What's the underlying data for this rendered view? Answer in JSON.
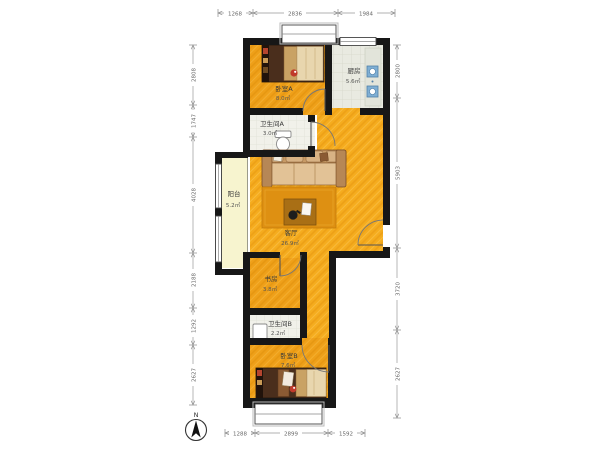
{
  "plan_title": "两室两卫户型平面图",
  "rooms": {
    "bedroom_a": {
      "name": "卧室A",
      "area": "8.0㎡"
    },
    "kitchen": {
      "name": "厨房",
      "area": "5.6㎡"
    },
    "bathroom_a": {
      "name": "卫生间A",
      "area": "3.0㎡"
    },
    "balcony": {
      "name": "阳台",
      "area": "5.2㎡"
    },
    "living_room": {
      "name": "客厅",
      "area": "26.9㎡"
    },
    "study": {
      "name": "书房",
      "area": "3.8㎡"
    },
    "bathroom_b": {
      "name": "卫生间B",
      "area": "2.2㎡"
    },
    "bedroom_b": {
      "name": "卧室B",
      "area": "7.6㎡"
    }
  },
  "dimensions": {
    "top": [
      "1268",
      "2836",
      "1984"
    ],
    "bottom": [
      "1288",
      "2899",
      "1592"
    ],
    "left": [
      "2808",
      "1747",
      "4028",
      "2188",
      "1292",
      "2627"
    ],
    "right": [
      "2800",
      "5903",
      "3720",
      "2627"
    ]
  },
  "compass": {
    "label": "N"
  },
  "colors": {
    "wall": "#171717",
    "floor_bedroom": "#EFA019",
    "floor_living": "#F5AC1E",
    "rug": "#DE9012",
    "kitchen_tile": "#E9EAE1",
    "bath_tile": "#F1F1EA",
    "balcony_floor": "#F7F4CF",
    "appliance_blue": "#7FAFD4"
  }
}
